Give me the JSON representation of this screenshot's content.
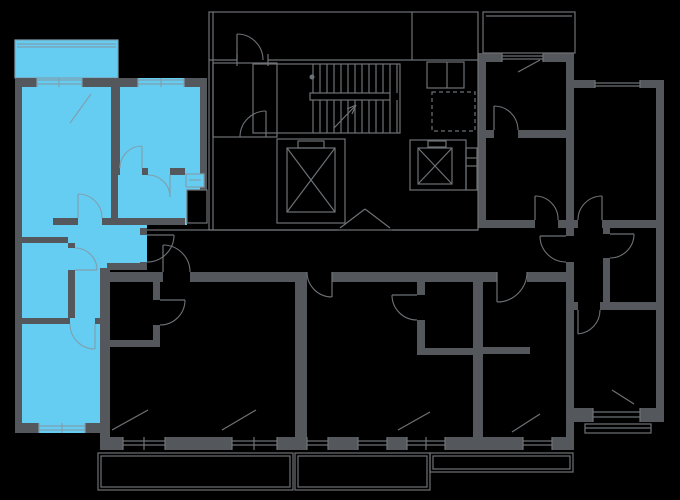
{
  "canvas": {
    "w": 680,
    "h": 500,
    "bg": "#000000"
  },
  "palette": {
    "wall": "#54585C",
    "line": "#6E7276",
    "highlight": "#66CDF2",
    "highlight_line": "#7FA0B0"
  },
  "highlighted_unit": {
    "outline_points": "15,78 207,78 207,190 187,190 187,225 147,225 147,268 107,268 107,433 15,433",
    "balcony_rect": [
      15,
      40,
      103,
      38
    ]
  },
  "walls": [
    [
      15,
      78,
      22,
      9
    ],
    [
      82,
      78,
      56,
      9
    ],
    [
      184,
      78,
      23,
      9
    ],
    [
      15,
      78,
      7,
      355
    ],
    [
      15,
      423,
      24,
      10
    ],
    [
      85,
      423,
      22,
      10
    ],
    [
      200,
      87,
      7,
      103
    ],
    [
      100,
      268,
      10,
      182
    ],
    [
      140,
      228,
      7,
      7
    ],
    [
      140,
      262,
      7,
      8
    ],
    [
      107,
      263,
      40,
      7
    ],
    [
      111,
      87,
      9,
      81
    ],
    [
      111,
      175,
      7,
      50
    ],
    [
      111,
      168,
      9,
      7
    ],
    [
      142,
      168,
      6,
      7
    ],
    [
      170,
      168,
      15,
      7
    ],
    [
      53,
      218,
      25,
      7
    ],
    [
      102,
      218,
      16,
      7
    ],
    [
      118,
      218,
      67,
      7
    ],
    [
      15,
      237,
      53,
      6
    ],
    [
      68,
      243,
      7,
      5
    ],
    [
      68,
      270,
      7,
      48
    ],
    [
      15,
      318,
      55,
      6
    ],
    [
      95,
      318,
      12,
      6
    ],
    [
      483,
      53,
      19,
      9
    ],
    [
      543,
      53,
      31,
      9
    ],
    [
      478,
      53,
      8,
      175
    ],
    [
      566,
      60,
      8,
      168
    ],
    [
      486,
      130,
      8,
      8
    ],
    [
      518,
      130,
      48,
      8
    ],
    [
      478,
      220,
      57,
      8
    ],
    [
      558,
      220,
      16,
      8
    ],
    [
      574,
      80,
      21,
      8
    ],
    [
      640,
      80,
      24,
      8
    ],
    [
      656,
      80,
      8,
      342
    ],
    [
      566,
      228,
      8,
      8
    ],
    [
      566,
      262,
      8,
      160
    ],
    [
      574,
      220,
      4,
      8
    ],
    [
      602,
      220,
      62,
      8
    ],
    [
      603,
      228,
      7,
      6
    ],
    [
      603,
      258,
      7,
      44
    ],
    [
      566,
      302,
      12,
      8
    ],
    [
      600,
      302,
      64,
      8
    ],
    [
      566,
      408,
      27,
      14
    ],
    [
      640,
      408,
      24,
      14
    ],
    [
      566,
      422,
      8,
      28
    ],
    [
      100,
      272,
      63,
      10
    ],
    [
      190,
      272,
      117,
      10
    ],
    [
      332,
      272,
      165,
      10
    ],
    [
      527,
      272,
      47,
      10
    ],
    [
      295,
      282,
      12,
      168
    ],
    [
      473,
      282,
      10,
      168
    ],
    [
      153,
      282,
      7,
      18
    ],
    [
      153,
      325,
      7,
      22
    ],
    [
      110,
      340,
      50,
      7
    ],
    [
      417,
      282,
      8,
      13
    ],
    [
      417,
      320,
      8,
      35
    ],
    [
      417,
      348,
      56,
      7
    ],
    [
      483,
      347,
      47,
      7
    ],
    [
      107,
      437,
      16,
      13
    ],
    [
      165,
      437,
      67,
      13
    ],
    [
      277,
      437,
      18,
      13
    ],
    [
      328,
      437,
      30,
      13
    ],
    [
      387,
      437,
      20,
      13
    ],
    [
      445,
      437,
      28,
      13
    ],
    [
      483,
      437,
      40,
      13
    ],
    [
      552,
      437,
      22,
      13
    ]
  ],
  "outline_rects": [
    [
      209,
      12,
      269,
      218
    ],
    [
      213,
      63,
      64,
      74
    ],
    [
      253,
      64,
      147,
      69
    ],
    [
      310,
      93,
      80,
      7
    ],
    [
      277,
      139,
      68,
      84
    ],
    [
      287,
      148,
      48,
      64
    ],
    [
      298,
      141,
      26,
      7
    ],
    [
      410,
      140,
      56,
      50
    ],
    [
      418,
      148,
      34,
      36
    ],
    [
      428,
      141,
      18,
      6
    ],
    [
      466,
      148,
      11,
      42
    ],
    [
      427,
      62,
      37,
      26
    ],
    [
      483,
      12,
      92,
      41
    ],
    [
      98,
      453,
      195,
      37
    ],
    [
      101,
      456,
      189,
      31
    ],
    [
      295,
      453,
      135,
      37
    ],
    [
      298,
      456,
      129,
      31
    ],
    [
      430,
      453,
      143,
      19
    ],
    [
      433,
      456,
      137,
      13
    ],
    [
      585,
      424,
      66,
      9
    ]
  ],
  "dashed_rects": [
    [
      432,
      92,
      43,
      39
    ]
  ],
  "filled_boxes": [
    {
      "r": [
        187,
        190,
        20,
        33
      ],
      "fill": "#000000",
      "stroke": "line"
    },
    {
      "r": [
        186,
        174,
        18,
        13
      ],
      "fill": "highlight",
      "stroke": "highlight_line"
    }
  ],
  "gray_lines": [
    [
      213,
      12,
      213,
      230
    ],
    [
      209,
      60,
      237,
      60
    ],
    [
      268,
      60,
      478,
      60
    ],
    [
      237,
      54,
      237,
      66
    ],
    [
      268,
      54,
      268,
      66
    ],
    [
      412,
      12,
      412,
      60
    ],
    [
      447,
      62,
      447,
      88
    ],
    [
      466,
      158,
      477,
      158
    ],
    [
      466,
      166,
      477,
      166
    ],
    [
      147,
      230,
      338,
      230
    ],
    [
      392,
      230,
      478,
      230
    ],
    [
      486,
      16,
      572,
      16
    ],
    [
      518,
      72,
      540,
      60
    ],
    [
      340,
      228,
      365,
      209
    ],
    [
      365,
      209,
      390,
      228
    ],
    [
      287,
      148,
      335,
      212
    ],
    [
      287,
      212,
      335,
      148
    ],
    [
      418,
      148,
      452,
      184
    ],
    [
      418,
      184,
      452,
      148
    ],
    [
      334,
      128,
      356,
      105
    ],
    [
      356,
      105,
      347,
      109
    ],
    [
      356,
      105,
      352,
      114
    ],
    [
      237,
      60,
      237,
      34
    ],
    [
      266,
      137,
      266,
      111
    ],
    [
      494,
      130,
      494,
      106
    ],
    [
      535,
      220,
      535,
      196
    ],
    [
      540,
      236,
      566,
      236
    ],
    [
      602,
      220,
      602,
      196
    ],
    [
      610,
      234,
      634,
      234
    ],
    [
      578,
      310,
      578,
      334
    ],
    [
      147,
      235,
      174,
      235
    ],
    [
      163,
      272,
      163,
      245
    ],
    [
      332,
      272,
      332,
      297
    ],
    [
      497,
      272,
      497,
      302
    ],
    [
      160,
      300,
      185,
      300
    ],
    [
      417,
      295,
      392,
      295
    ],
    [
      313,
      64,
      313,
      93
    ],
    [
      320,
      64,
      320,
      93
    ],
    [
      327,
      64,
      327,
      93
    ],
    [
      334,
      64,
      334,
      93
    ],
    [
      341,
      64,
      341,
      93
    ],
    [
      348,
      64,
      348,
      93
    ],
    [
      355,
      64,
      355,
      93
    ],
    [
      362,
      64,
      362,
      93
    ],
    [
      369,
      64,
      369,
      93
    ],
    [
      376,
      64,
      376,
      93
    ],
    [
      383,
      64,
      383,
      93
    ],
    [
      390,
      64,
      390,
      93
    ],
    [
      397,
      64,
      397,
      93
    ],
    [
      313,
      100,
      313,
      133
    ],
    [
      320,
      100,
      320,
      133
    ],
    [
      327,
      100,
      327,
      133
    ],
    [
      334,
      100,
      334,
      133
    ],
    [
      341,
      100,
      341,
      133
    ],
    [
      348,
      100,
      348,
      133
    ],
    [
      355,
      100,
      355,
      133
    ],
    [
      362,
      100,
      362,
      133
    ],
    [
      369,
      100,
      369,
      133
    ],
    [
      376,
      100,
      376,
      133
    ],
    [
      383,
      100,
      383,
      133
    ],
    [
      390,
      100,
      390,
      133
    ],
    [
      397,
      100,
      397,
      133
    ],
    [
      502,
      56,
      543,
      56
    ],
    [
      502,
      59,
      543,
      59
    ],
    [
      502,
      53,
      502,
      62
    ],
    [
      543,
      53,
      543,
      62
    ],
    [
      595,
      83,
      640,
      83
    ],
    [
      595,
      86,
      640,
      86
    ],
    [
      595,
      80,
      595,
      88
    ],
    [
      640,
      80,
      640,
      88
    ],
    [
      593,
      412,
      640,
      412
    ],
    [
      593,
      417,
      640,
      417
    ],
    [
      593,
      408,
      593,
      422
    ],
    [
      640,
      408,
      640,
      422
    ],
    [
      123,
      441,
      165,
      441
    ],
    [
      123,
      445,
      165,
      445
    ],
    [
      123,
      437,
      123,
      450
    ],
    [
      144,
      437,
      144,
      450
    ],
    [
      165,
      437,
      165,
      450
    ],
    [
      232,
      441,
      277,
      441
    ],
    [
      232,
      445,
      277,
      445
    ],
    [
      232,
      437,
      232,
      450
    ],
    [
      254,
      437,
      254,
      450
    ],
    [
      277,
      437,
      277,
      450
    ],
    [
      307,
      441,
      328,
      441
    ],
    [
      307,
      445,
      328,
      445
    ],
    [
      307,
      437,
      307,
      450
    ],
    [
      328,
      437,
      328,
      450
    ],
    [
      358,
      441,
      387,
      441
    ],
    [
      358,
      445,
      387,
      445
    ],
    [
      358,
      437,
      358,
      450
    ],
    [
      387,
      437,
      387,
      450
    ],
    [
      407,
      441,
      445,
      441
    ],
    [
      407,
      445,
      445,
      445
    ],
    [
      407,
      437,
      407,
      450
    ],
    [
      426,
      437,
      426,
      450
    ],
    [
      445,
      437,
      445,
      450
    ],
    [
      523,
      441,
      552,
      441
    ],
    [
      523,
      445,
      552,
      445
    ],
    [
      523,
      437,
      523,
      450
    ],
    [
      552,
      437,
      552,
      450
    ],
    [
      112,
      430,
      148,
      410
    ],
    [
      222,
      430,
      256,
      410
    ],
    [
      398,
      430,
      430,
      412
    ],
    [
      512,
      432,
      540,
      414
    ],
    [
      612,
      390,
      634,
      404
    ],
    [
      585,
      428,
      651,
      428
    ]
  ],
  "blue_lines": [
    [
      17,
      44,
      116,
      44
    ],
    [
      17,
      47,
      116,
      47
    ],
    [
      37,
      80,
      82,
      80
    ],
    [
      37,
      84,
      82,
      84
    ],
    [
      37,
      78,
      37,
      87
    ],
    [
      59,
      78,
      59,
      87
    ],
    [
      82,
      78,
      82,
      87
    ],
    [
      138,
      80,
      184,
      80
    ],
    [
      138,
      84,
      184,
      84
    ],
    [
      138,
      78,
      138,
      87
    ],
    [
      161,
      78,
      161,
      87
    ],
    [
      184,
      78,
      184,
      87
    ],
    [
      39,
      426,
      85,
      426
    ],
    [
      39,
      430,
      85,
      430
    ],
    [
      39,
      423,
      39,
      433
    ],
    [
      62,
      423,
      62,
      433
    ],
    [
      85,
      423,
      85,
      433
    ],
    [
      142,
      168,
      142,
      146
    ],
    [
      170,
      175,
      170,
      197
    ],
    [
      78,
      218,
      78,
      194
    ],
    [
      75,
      270,
      97,
      270
    ],
    [
      95,
      324,
      95,
      349
    ],
    [
      70,
      123,
      91,
      94
    ],
    [
      189,
      180,
      201,
      180
    ]
  ],
  "gray_arcs": [
    "M174,235 A27,27 0 0 1 147,262",
    "M237,34 A26,26 0 0 1 263,60",
    "M266,111 A26,26 0 0 0 240,137",
    "M494,106 A24,24 0 0 1 518,130",
    "M535,196 A23,23 0 0 1 558,220",
    "M540,236 A26,26 0 0 0 566,262",
    "M602,196 A24,24 0 0 0 578,220",
    "M634,234 A24,24 0 0 1 610,258",
    "M578,334 A24,24 0 0 0 600,310",
    "M163,245 A27,27 0 0 1 190,272",
    "M332,297 A25,25 0 0 1 307,272",
    "M497,302 A30,30 0 0 0 527,272",
    "M185,300 A25,25 0 0 1 160,325",
    "M392,295 A25,25 0 0 0 417,320"
  ],
  "blue_arcs": [
    "M142,146 A22,22 0 0 0 120,168",
    "M170,197 A22,22 0 0 0 148,175",
    "M78,194 A24,24 0 0 1 102,218",
    "M97,270 A22,22 0 0 0 75,248",
    "M95,349 A25,25 0 0 1 70,324"
  ],
  "dots": [
    [
      312,
      77,
      2.5
    ]
  ]
}
